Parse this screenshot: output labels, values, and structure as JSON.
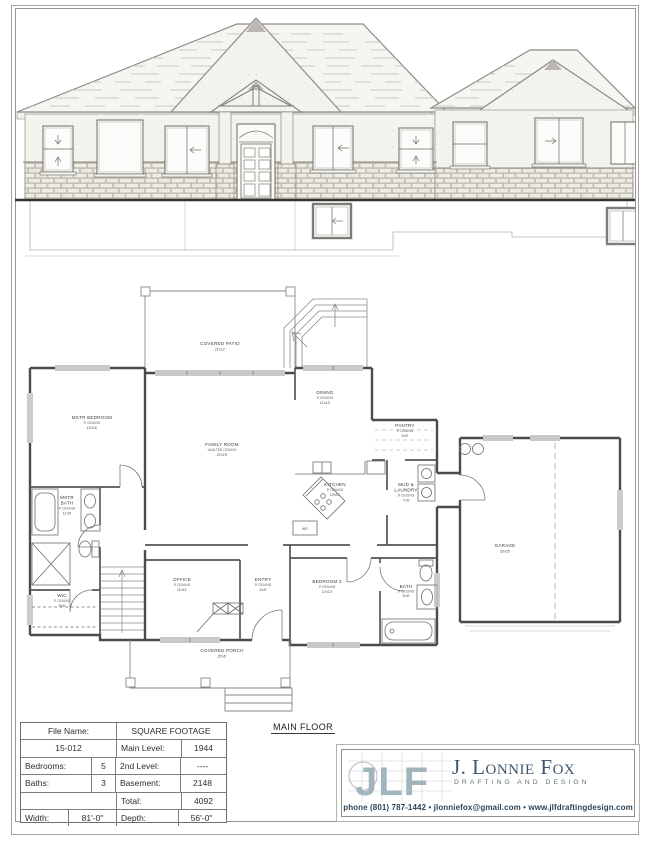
{
  "sheet": {
    "main_floor_label": "MAIN FLOOR"
  },
  "info_table": {
    "file_name_label": "File Name:",
    "file_name_value": "15-012",
    "sqft_header": "SQUARE FOOTAGE",
    "main_level_label": "Main Level:",
    "main_level_value": "1944",
    "bedrooms_label": "Bedrooms:",
    "bedrooms_value": "5",
    "second_level_label": "2nd Level:",
    "second_level_value": "----",
    "baths_label": "Baths:",
    "baths_value": "3",
    "basement_label": "Basement:",
    "basement_value": "2148",
    "total_label": "Total:",
    "total_value": "4092",
    "width_label": "Width:",
    "width_value": "81'-0\"",
    "depth_label": "Depth:",
    "depth_value": "56'-0\""
  },
  "logo": {
    "monogram": "JLF",
    "name": "J. Lonnie Fox",
    "tagline": "DRAFTING AND DESIGN",
    "contact": "phone (801) 787-1442 • jlonniefox@gmail.com • www.jlfdraftingdesign.com",
    "accent_color": "#a2b5bc",
    "name_color": "#3e566b"
  },
  "plan": {
    "rooms": [
      {
        "l1": "COVERED PATIO",
        "l2": "21'x12'",
        "l3": "",
        "l4": ""
      },
      {
        "l1": "MSTR BEDROOM",
        "l2": "9' CEILING",
        "l3": "13'x16'",
        "l4": ""
      },
      {
        "l1": "FAMILY ROOM",
        "l2": "VAULTED CEILING",
        "l3": "20'x19'",
        "l4": ""
      },
      {
        "l1": "DINING",
        "l2": "9' CEILING",
        "l3": "11'x13'",
        "l4": ""
      },
      {
        "l1": "PANTRY",
        "l2": "9' CEILING",
        "l3": "5'x5'",
        "l4": ""
      },
      {
        "l1": "KITCHEN",
        "l2": "9' CEILING",
        "l3": "13'x14'",
        "l4": ""
      },
      {
        "l1": "MUD &",
        "l2": "LAUNDRY",
        "l3": "9' CEILING",
        "l4": "7'x9'"
      },
      {
        "l1": "GARAGE",
        "l2": "33'x25'",
        "l3": "",
        "l4": ""
      },
      {
        "l1": "MSTR",
        "l2": "BATH",
        "l3": "9' CEILING",
        "l4": "11'x9'"
      },
      {
        "l1": "WIC",
        "l2": "9' CEILING",
        "l3": "9'x5'",
        "l4": ""
      },
      {
        "l1": "OFFICE",
        "l2": "9' CEILING",
        "l3": "11'x11'",
        "l4": ""
      },
      {
        "l1": "ENTRY",
        "l2": "9' CEILING",
        "l3": "6'x9'",
        "l4": ""
      },
      {
        "l1": "BEDROOM 2",
        "l2": "9' CEILING",
        "l3": "12'x13'",
        "l4": ""
      },
      {
        "l1": "BATH",
        "l2": "9' CEILING",
        "l3": "8'x5'",
        "l4": ""
      },
      {
        "l1": "COVERED PORCH",
        "l2": "25'x6'",
        "l3": "",
        "l4": ""
      },
      {
        "l1": "AIR",
        "l2": "",
        "l3": "",
        "l4": ""
      }
    ]
  }
}
